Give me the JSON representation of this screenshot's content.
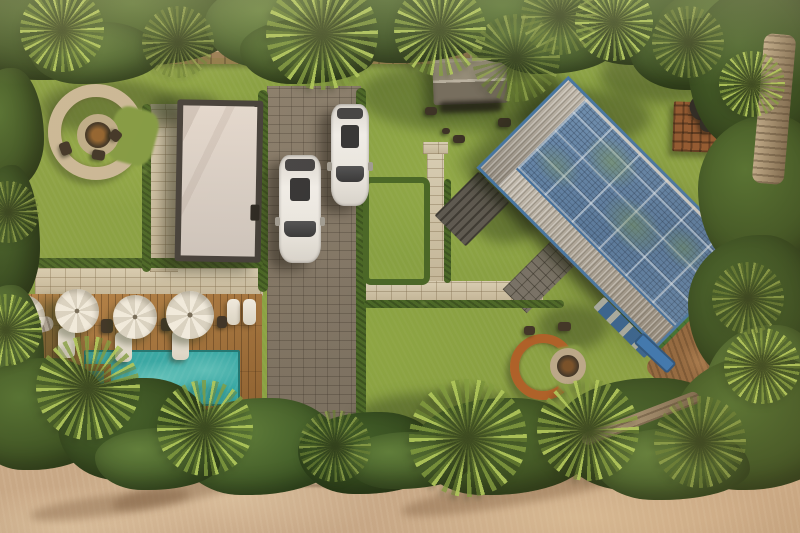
{
  "scene": {
    "description": "Aerial top-down drone photograph of a tropical villa property at golden hour, ringed by palm trees with a sandy beach strip along the bottom edge",
    "view": "top-down aerial",
    "lighting": "warm golden-hour sunlight from the upper right, long shadows falling left",
    "counts": {
      "parasols": 4,
      "white_suvs": 2,
      "fire_pit_lounges": 2,
      "sun_loungers": 5,
      "buildings": 3
    },
    "objects": {
      "solar_house": "Main house set diagonally with a large rooftop photovoltaic solar-panel array, silver corrugated metal roofing and blue trim",
      "garage_studio": "Flat white-roofed outbuilding with dark roof border beside the driveway",
      "gazebo": "Small gabled-roof garden pavilion on the north lawn",
      "driveway": "Grey block-paved driveway with two white SUVs parked, ending at dark entry steps onto the sand",
      "pool_area": "Turquoise swimming pool in a hardwood deck with four white parasols, sun loungers and a daybed",
      "fire_pit_north": "Round stone fire pit encircled by a curved stone bench with small chairs",
      "fire_pit_south": "Round fire pit encircled by a curved rust-steel bench on the south lawn",
      "paths": "Light stone paver paths with clipped hedges connecting the lawns",
      "wooden_platform": "Slatted timber platform with dark gear bags near the house",
      "vegetation": "Dense tropical canopy and coconut palms bordering the property"
    },
    "palette": {
      "lawn": "#819c3b",
      "lawn_shadow": "#54702c",
      "hedge": "#41601f",
      "canopy_dark": "#2c461a",
      "palm_frond": "#9cbb4e",
      "stone_path": "#cbbfa3",
      "driveway": "#867a6a",
      "deck_wood": "#9c6a33",
      "pool_water": "#2aa3a3",
      "pool_light": "#6ecdc6",
      "parasol_white": "#f0ebe0",
      "garage_roof": "#d8d1cc",
      "roof_border": "#3a3633",
      "solar_blue": "#5d81a9",
      "solar_grid": "#12223a",
      "metal_roof": "#a9a298",
      "trim_blue": "#3c6fa0",
      "house_wall_blue": "#2a5a8c",
      "rust_bench": "#a8571f",
      "firepit_stone": "#c6b596",
      "sand": "#c3a383",
      "gazebo_roof": "#8e8674",
      "car_white": "#e7e4df",
      "turf": "#3a7a32",
      "dirt": "#8a5f38",
      "trunk": "#9a8465",
      "boundary_wall": "#86693f"
    }
  }
}
